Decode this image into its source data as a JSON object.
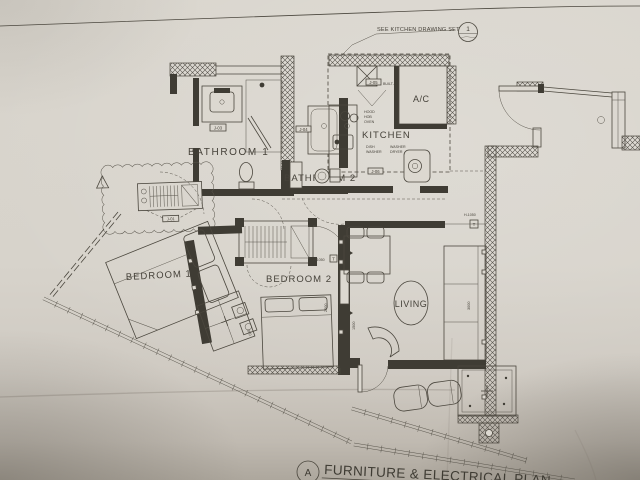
{
  "drawing": {
    "sheet_title": "FURNITURE & ELECTRICAL PLAN",
    "sheet_ref": "A",
    "kitchen_note": "SEE KITCHEN DRAWING SET",
    "kitchen_note_ref": "1"
  },
  "rooms": {
    "bathroom1": "BATHROOM 1",
    "bathroom2": "BATHROOM 2",
    "kitchen": "KITCHEN",
    "ac": "A/C",
    "bedroom1": "BEDROOM 1",
    "bedroom2": "BEDROOM 2",
    "living": "LIVING"
  },
  "tags": {
    "j01": "J-01",
    "j03": "J-03",
    "j04": "J-04",
    "j05": "J-05",
    "j06": "J-06"
  },
  "appliances": {
    "built_in": "BUILT-IN",
    "hood": "HOOD",
    "hob": "HOB",
    "oven": "OVEN",
    "dish_1": "DISH",
    "dish_2": "WASHER",
    "wd_1": "WASHER",
    "wd_2": "DRYER"
  },
  "heights": {
    "wardrobe": "H 1050",
    "living_wall": "H-1050",
    "thermostat": "T"
  },
  "dimensions": {
    "sofa": "3000",
    "living": "1500",
    "bedroom2": "2000",
    "bedroom1": "950"
  },
  "colors": {
    "paper": "#d7d3cb",
    "ink": "#4b473e"
  }
}
